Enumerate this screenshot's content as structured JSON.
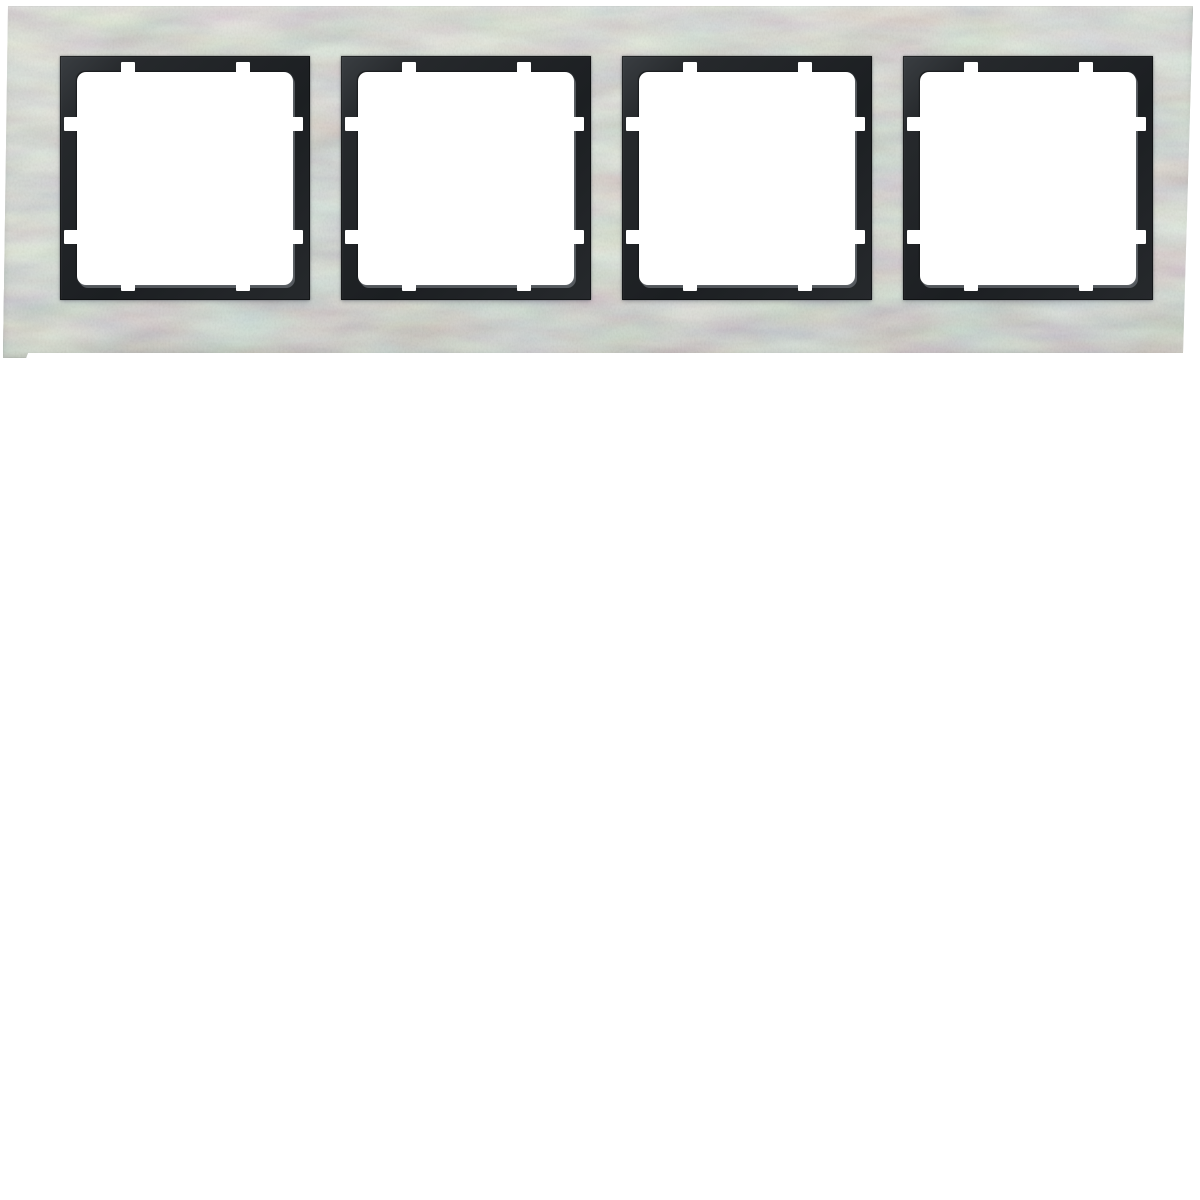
{
  "colors": {
    "background": "#ffffff",
    "plate_base": "#cdd1cb",
    "plate_light": "#d7dad3",
    "plate_dark": "#bdc2bd",
    "frame_dark": "#26292c",
    "frame_darkest": "#1c1f22",
    "frame_highlight": "#3a3e42",
    "bevel_gray": "#80858a",
    "opening_white": "#ffffff",
    "shadow_tint": "#6e7480"
  },
  "scene": {
    "label": "Product photo: 4-gang cover frame, brushed steel with anthracite inner frames on white background",
    "plate": {
      "label": "Brushed stainless steel cover plate",
      "gang_count": 4
    },
    "modules": [
      {
        "label": "Gang opening 1"
      },
      {
        "label": "Gang opening 2"
      },
      {
        "label": "Gang opening 3"
      },
      {
        "label": "Gang opening 4"
      }
    ]
  }
}
